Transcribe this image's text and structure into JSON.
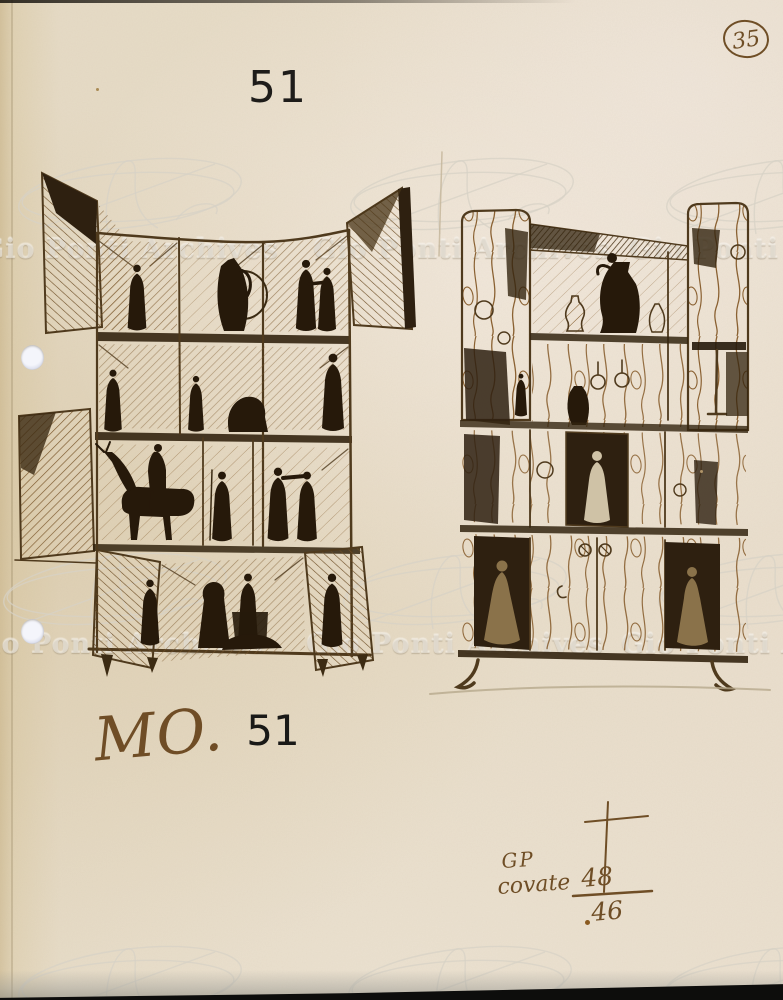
{
  "header": {
    "sheet_number": "51",
    "folio_number": "35"
  },
  "caption": {
    "prefix": "MO.",
    "number": "51"
  },
  "annotation": {
    "initials": "GP",
    "word": "covate",
    "numerator": "48",
    "denominator": "46"
  },
  "watermark": {
    "text": "Gio Ponti Archives"
  },
  "colors": {
    "paper": "#e6dbc6",
    "ink": "#5a4120",
    "ink_dark": "#2c1f0e",
    "handwriting": "#6f4e26",
    "print_black": "#1e1c1a",
    "pencil": "#b7a98c",
    "watermark_text": "#eeeade"
  }
}
